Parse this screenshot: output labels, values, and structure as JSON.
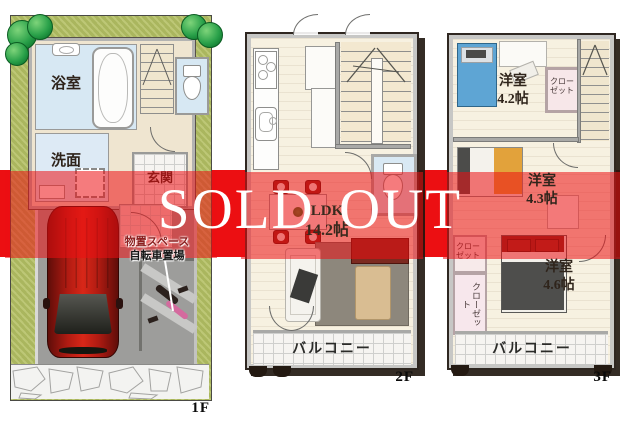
{
  "banner": {
    "text": "SOLD OUT",
    "text_color": "#ffffff",
    "band_color": "#ec0f12"
  },
  "floor1": {
    "label": "1F",
    "rooms": {
      "bath": "浴室",
      "washroom": "洗面",
      "entrance": "玄関"
    },
    "annotations": {
      "storage": "物置スペース",
      "bicycle": "自転車置場"
    }
  },
  "floor2": {
    "label": "2F",
    "rooms": {
      "ldk_name": "LDK",
      "ldk_size": "14.2帖",
      "balcony": "バルコニー"
    }
  },
  "floor3": {
    "label": "3F",
    "rooms": {
      "bedroom1_name": "洋室",
      "bedroom1_size": "4.2帖",
      "bedroom2_name": "洋室",
      "bedroom2_size": "4.3帖",
      "bedroom3_name": "洋室",
      "bedroom3_size": "4.6帖",
      "closet_line1": "クロー",
      "closet_line2": "ゼット",
      "closet_vertical": "クローゼット",
      "balcony": "バルコニー"
    }
  },
  "colors": {
    "band_red": "#ec0f12",
    "lawn_green": "#b6c167",
    "driveway_gray": "#9d9d9b",
    "floor_beige": "#f7f1e1",
    "bath_blue": "#d7e8f3",
    "car_red": "#c21e16",
    "bed_blue": "#5ea5d4",
    "blanket_orange": "#e2a23b",
    "wall_dark": "#2f2721"
  }
}
